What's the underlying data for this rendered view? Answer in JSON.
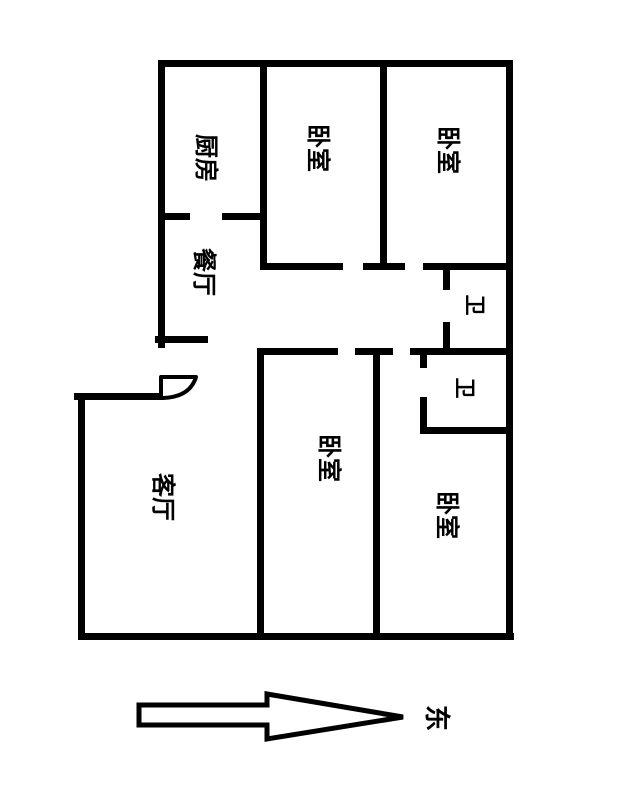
{
  "floorplan": {
    "background": "#ffffff",
    "wall_color": "#000000",
    "text_color": "#000000",
    "label_rotation_deg": 90,
    "labels": [
      {
        "name": "kitchen",
        "text": "厨房",
        "x": 206,
        "y": 158,
        "size": 24
      },
      {
        "name": "dining-room",
        "text": "餐厅",
        "x": 204,
        "y": 272,
        "size": 24
      },
      {
        "name": "bedroom-top-mid",
        "text": "卧室",
        "x": 318,
        "y": 148,
        "size": 24
      },
      {
        "name": "bedroom-top-right",
        "text": "卧室",
        "x": 448,
        "y": 150,
        "size": 24
      },
      {
        "name": "bathroom-upper",
        "text": "卫",
        "x": 474,
        "y": 305,
        "size": 21
      },
      {
        "name": "bathroom-lower",
        "text": "卫",
        "x": 464,
        "y": 388,
        "size": 21
      },
      {
        "name": "bedroom-bot-mid",
        "text": "卧室",
        "x": 329,
        "y": 458,
        "size": 24
      },
      {
        "name": "living-room",
        "text": "客厅",
        "x": 163,
        "y": 497,
        "size": 24
      },
      {
        "name": "bedroom-bot-right",
        "text": "卧室",
        "x": 447,
        "y": 515,
        "size": 24
      }
    ],
    "walls": [
      {
        "name": "outer-top-wall",
        "x": 158,
        "y": 60,
        "w": 355,
        "h": 7
      },
      {
        "name": "kitchen-dining-wall-left",
        "x": 158,
        "y": 213,
        "w": 32,
        "h": 7
      },
      {
        "name": "kitchen-dining-wall-right",
        "x": 222,
        "y": 213,
        "w": 45,
        "h": 7
      },
      {
        "name": "corridor-top-wall-left",
        "x": 260,
        "y": 263,
        "w": 83,
        "h": 7
      },
      {
        "name": "corridor-top-wall-mid",
        "x": 363,
        "y": 263,
        "w": 42,
        "h": 7
      },
      {
        "name": "corridor-top-wall-right",
        "x": 423,
        "y": 263,
        "w": 84,
        "h": 7
      },
      {
        "name": "corridor-bottom-wall-left",
        "x": 258,
        "y": 348,
        "w": 80,
        "h": 7
      },
      {
        "name": "corridor-bottom-wall-mid",
        "x": 355,
        "y": 348,
        "w": 38,
        "h": 7
      },
      {
        "name": "corridor-bottom-wall-right",
        "x": 410,
        "y": 348,
        "w": 97,
        "h": 7
      },
      {
        "name": "bathroom-lower-bottom-wall",
        "x": 420,
        "y": 427,
        "w": 93,
        "h": 7
      },
      {
        "name": "dining-bottom-wall",
        "x": 155,
        "y": 336,
        "w": 53,
        "h": 7
      },
      {
        "name": "living-room-top-wall",
        "x": 74,
        "y": 393,
        "w": 90,
        "h": 7
      },
      {
        "name": "outer-bottom-wall",
        "x": 78,
        "y": 633,
        "w": 436,
        "h": 7
      },
      {
        "name": "outer-left-wall-upper",
        "x": 158,
        "y": 60,
        "w": 7,
        "h": 288
      },
      {
        "name": "outer-left-wall-lower",
        "x": 78,
        "y": 393,
        "w": 7,
        "h": 247
      },
      {
        "name": "outer-right-wall",
        "x": 506,
        "y": 60,
        "w": 7,
        "h": 580
      },
      {
        "name": "kitchen-bedroom-wall",
        "x": 260,
        "y": 60,
        "w": 7,
        "h": 210
      },
      {
        "name": "bedrooms-divider-wall",
        "x": 380,
        "y": 60,
        "w": 7,
        "h": 210
      },
      {
        "name": "bathroom-upper-left-wall-a",
        "x": 443,
        "y": 266,
        "w": 7,
        "h": 24
      },
      {
        "name": "bathroom-upper-left-wall-b",
        "x": 443,
        "y": 322,
        "w": 7,
        "h": 33
      },
      {
        "name": "bedroom-bot-mid-left-wall",
        "x": 257,
        "y": 348,
        "w": 7,
        "h": 292
      },
      {
        "name": "bedroom-bot-mid-right-wall",
        "x": 373,
        "y": 352,
        "w": 7,
        "h": 288
      },
      {
        "name": "bathroom-lower-left-wall-a",
        "x": 420,
        "y": 350,
        "w": 7,
        "h": 18
      },
      {
        "name": "bathroom-lower-left-wall-b",
        "x": 420,
        "y": 397,
        "w": 7,
        "h": 37
      }
    ],
    "door_arc": {
      "path": "M 161 377 L 196 377 Q 190 397 163 398 L 161 398 Z"
    },
    "compass": {
      "label": "东",
      "label_x": 436,
      "label_y": 718,
      "label_size": 26,
      "arrow_points": "139,705 267,705 267,694 403,717 267,739 267,725 139,725"
    }
  }
}
